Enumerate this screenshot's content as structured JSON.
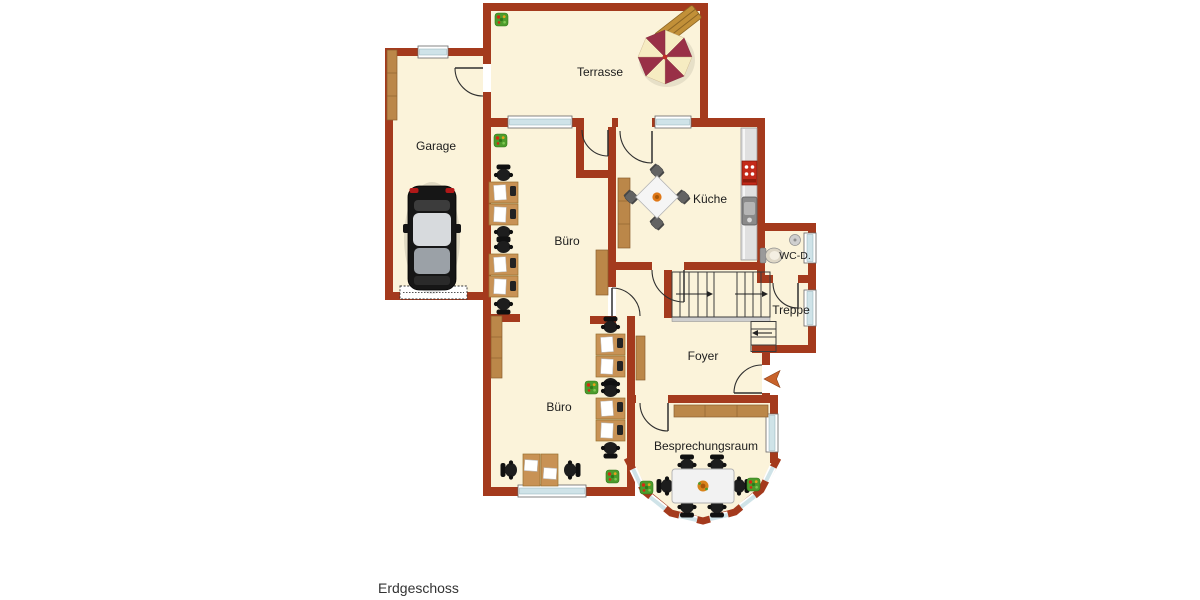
{
  "title": "Erdgeschoss",
  "floor_plan": {
    "floor_label": "Erdgeschoss",
    "rooms": {
      "terrasse": "Terrasse",
      "garage": "Garage",
      "buero_top": "Büro",
      "kueche": "Küche",
      "wc": "WC-D.",
      "treppe": "Treppe",
      "foyer": "Foyer",
      "buero_bottom": "Büro",
      "besprechungsraum": "Besprechungsraum"
    }
  },
  "colors": {
    "wall": "#a43a1d",
    "floor": "#fbf3da",
    "wood": "#bb8749",
    "desk": "#c89255",
    "window": "#cfe3e8",
    "chair": "#1d1d1d",
    "counter": "#e0e0e0",
    "stove": "#c42a1a",
    "plant": "#4c9b2c",
    "arrow": "#c8622a",
    "parasol_dark": "#993047",
    "parasol_light": "#f6ecc2",
    "text": "#1c1c1c",
    "background": "#ffffff"
  }
}
